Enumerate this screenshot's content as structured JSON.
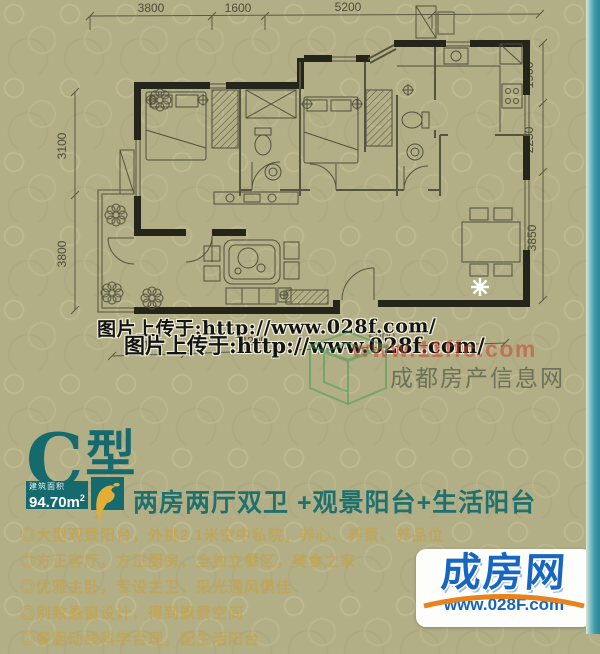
{
  "colors": {
    "teal": "#156a6e",
    "gold": "#c9a23b",
    "blue": "#1767c0",
    "orange": "#e8821e",
    "background": "#b2ae86",
    "edge_strip": "#3f9cab"
  },
  "floorplan": {
    "dims_top": [
      "3800",
      "1600",
      "5200"
    ],
    "dims_right": [
      "1900",
      "2250",
      "3850"
    ],
    "dims_left": [
      "3100",
      "3800"
    ],
    "dims_bottom": [
      "2100",
      "4200",
      "5200"
    ]
  },
  "watermarks": {
    "upload_text_1": "图片上传于:http://www.028f.com/",
    "upload_text_2": "图片上传于:http://www.028f.com/",
    "red_url": "www.11ffc.com",
    "site_name": "成都房产信息网"
  },
  "unit": {
    "type_letter": "C",
    "type_word": "型",
    "area_caption": "建筑面积",
    "area_value": "94.70m",
    "area_sup": "2",
    "headline": "两房两厅双卫  +观景阳台+生活阳台"
  },
  "features": [
    "◎大型观景阳台，外挑2.1米空中私院，养心、养景、养品位",
    "◎方正客厅，方正厨房，全独立餐区，美食之家",
    "◎优雅主卧，专设主卫，采光通风俱佳",
    "◎别致悬窗设计，得到飘景空间",
    "◎餐厨动线科学合理，配生活阳台"
  ],
  "logo": {
    "brand": "成房网",
    "url": "www.028F.com"
  }
}
